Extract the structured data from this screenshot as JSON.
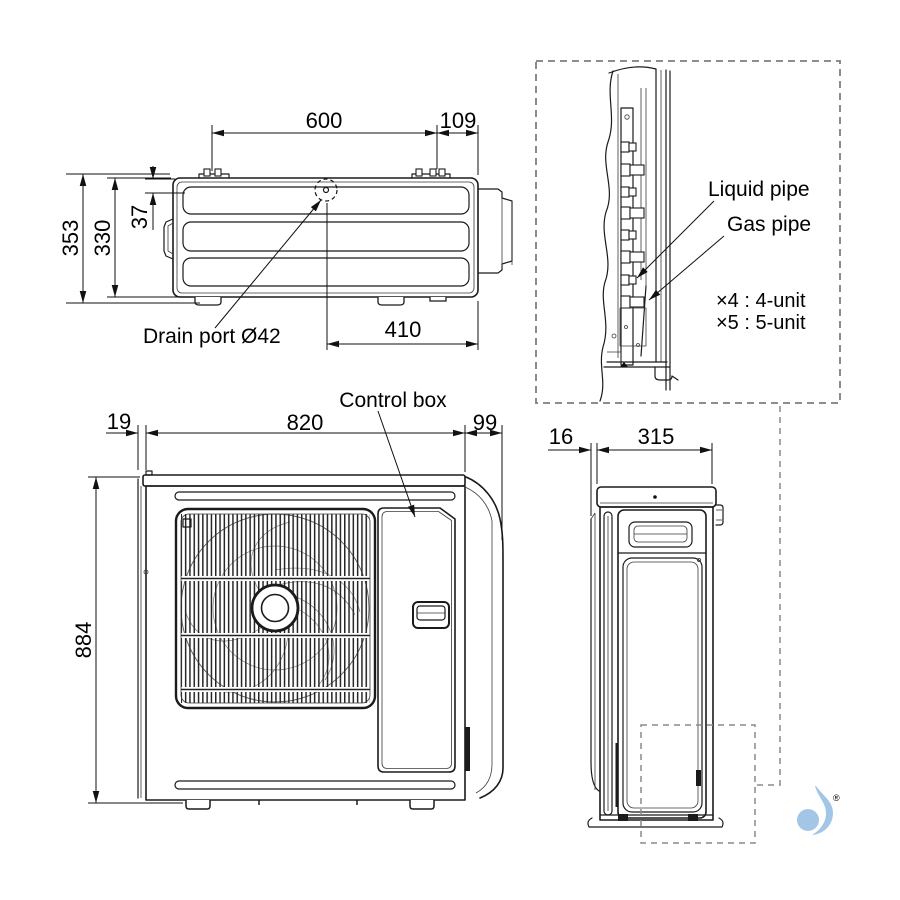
{
  "top_view": {
    "dim_600": "600",
    "dim_109": "109",
    "dim_353": "353",
    "dim_330": "330",
    "dim_37": "37",
    "dim_410": "410",
    "drain_label": "Drain port Ø42"
  },
  "detail_view": {
    "liquid_pipe": "Liquid pipe",
    "gas_pipe": "Gas pipe",
    "multi_4": "×4 : 4-unit",
    "multi_5": "×5 : 5-unit"
  },
  "front_view": {
    "dim_19": "19",
    "dim_820": "820",
    "dim_99": "99",
    "dim_884": "884",
    "control_box": "Control box"
  },
  "side_view": {
    "dim_16": "16",
    "dim_315": "315"
  },
  "logo": {
    "registered": "®",
    "color": "#a3c6e6"
  }
}
